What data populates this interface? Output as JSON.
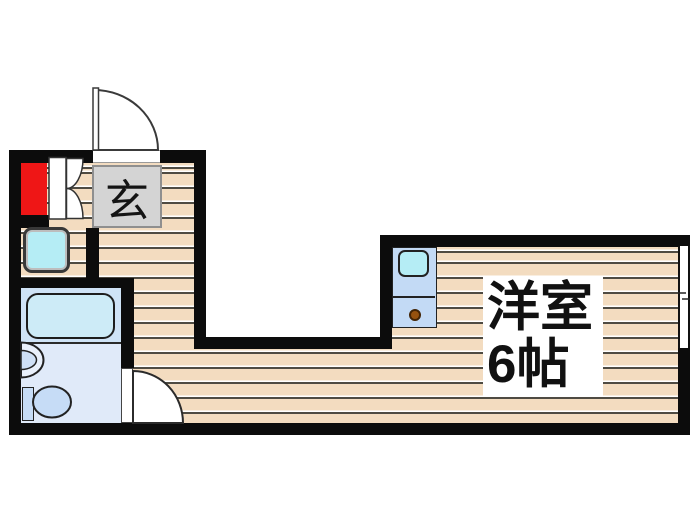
{
  "plan": {
    "title": "apartment-floor-plan",
    "rooms": {
      "genkan_label": "玄",
      "main_room_label": "洋室",
      "main_room_size": "6帖"
    },
    "fixtures": [
      "entry-door",
      "closet-double-door",
      "refrigerator-red-unit",
      "washing-machine-pan",
      "bathtub",
      "washbasin",
      "toilet",
      "bathroom-door",
      "kitchen-counter",
      "kitchen-sink",
      "stove-burner",
      "sliding-window"
    ]
  },
  "colors": {
    "wall": "#0c0c0c",
    "wood": "#f3dcc0",
    "plank-line": "#4f4b42",
    "bath-upper": "#cfe3f6",
    "bath-lower": "#e0eaf9",
    "tub": "#cdebf7",
    "fixture-blue": "#c6dcf6",
    "cyan": "#b5edf5",
    "counter": "#c3daf5",
    "genkan-gray": "#d4d4d4",
    "accent-red": "#ef1616",
    "burner": "#96520f"
  }
}
